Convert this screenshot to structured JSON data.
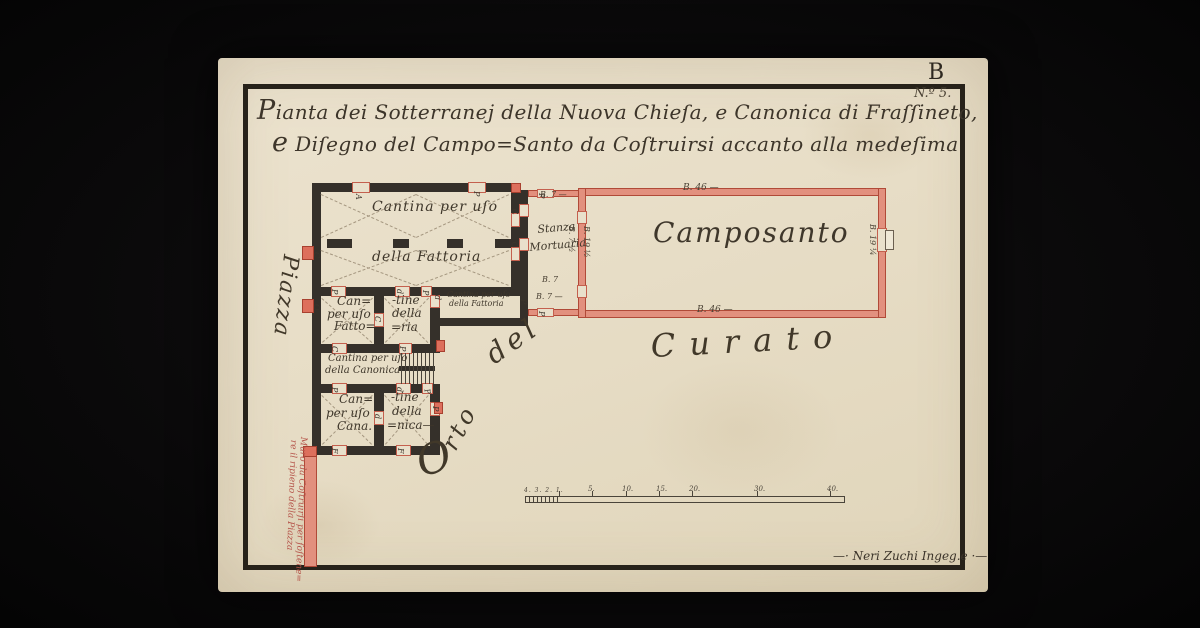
{
  "colors": {
    "paper": "#e8dfca",
    "ink": "#3d352a",
    "wall_dark": "#35302a",
    "wall_red_fill": "#e2907e",
    "wall_red_line": "#b04a38",
    "pier_red": "#dd6f5c",
    "note_red": "#b5544a"
  },
  "sheet": {
    "corner_letter": "B",
    "number": "N.º 5."
  },
  "title": {
    "line1": "Pianta dei Sotterranej della Nuova Chieſa, e Canonica di Fraſſineto,",
    "line2": "e Diſegno del Campo=Santo da Coſtruirsi accanto alla medeſima"
  },
  "plan": {
    "walls_dark": [
      {
        "x": 312,
        "y": 183,
        "w": 208,
        "h": 9
      },
      {
        "x": 312,
        "y": 183,
        "w": 9,
        "h": 272
      },
      {
        "x": 511,
        "y": 183,
        "w": 9,
        "h": 112
      },
      {
        "x": 312,
        "y": 287,
        "w": 216,
        "h": 9
      },
      {
        "x": 327,
        "y": 239,
        "w": 25,
        "h": 9
      },
      {
        "x": 393,
        "y": 239,
        "w": 16,
        "h": 9
      },
      {
        "x": 447,
        "y": 239,
        "w": 16,
        "h": 9
      },
      {
        "x": 495,
        "y": 239,
        "w": 16,
        "h": 9
      },
      {
        "x": 374,
        "y": 296,
        "w": 10,
        "h": 57
      },
      {
        "x": 430,
        "y": 296,
        "w": 10,
        "h": 57
      },
      {
        "x": 312,
        "y": 344,
        "w": 128,
        "h": 9
      },
      {
        "x": 374,
        "y": 393,
        "w": 10,
        "h": 62
      },
      {
        "x": 430,
        "y": 393,
        "w": 10,
        "h": 62
      },
      {
        "x": 312,
        "y": 384,
        "w": 128,
        "h": 9
      },
      {
        "x": 312,
        "y": 446,
        "w": 128,
        "h": 9
      },
      {
        "x": 440,
        "y": 318,
        "w": 80,
        "h": 8
      },
      {
        "x": 520,
        "y": 190,
        "w": 8,
        "h": 136
      },
      {
        "x": 399,
        "y": 366,
        "w": 36,
        "h": 5
      }
    ],
    "walls_red": [
      {
        "x": 528,
        "y": 190,
        "w": 52,
        "h": 7
      },
      {
        "x": 528,
        "y": 309,
        "w": 52,
        "h": 7
      },
      {
        "x": 578,
        "y": 188,
        "w": 308,
        "h": 8
      },
      {
        "x": 578,
        "y": 310,
        "w": 308,
        "h": 8
      },
      {
        "x": 578,
        "y": 188,
        "w": 8,
        "h": 130
      },
      {
        "x": 878,
        "y": 188,
        "w": 8,
        "h": 130
      },
      {
        "x": 304,
        "y": 455,
        "w": 13,
        "h": 112
      }
    ],
    "openings": [
      {
        "x": 352,
        "y": 182,
        "w": 18,
        "h": 11
      },
      {
        "x": 468,
        "y": 182,
        "w": 18,
        "h": 11
      },
      {
        "x": 511,
        "y": 213,
        "w": 9,
        "h": 14
      },
      {
        "x": 511,
        "y": 247,
        "w": 9,
        "h": 14
      },
      {
        "x": 331,
        "y": 286,
        "w": 15,
        "h": 11
      },
      {
        "x": 395,
        "y": 286,
        "w": 15,
        "h": 11
      },
      {
        "x": 421,
        "y": 286,
        "w": 11,
        "h": 11
      },
      {
        "x": 430,
        "y": 295,
        "w": 10,
        "h": 13
      },
      {
        "x": 332,
        "y": 343,
        "w": 15,
        "h": 11
      },
      {
        "x": 399,
        "y": 343,
        "w": 13,
        "h": 11
      },
      {
        "x": 332,
        "y": 383,
        "w": 15,
        "h": 11
      },
      {
        "x": 396,
        "y": 383,
        "w": 15,
        "h": 11
      },
      {
        "x": 422,
        "y": 383,
        "w": 11,
        "h": 11
      },
      {
        "x": 374,
        "y": 313,
        "w": 10,
        "h": 14
      },
      {
        "x": 374,
        "y": 411,
        "w": 10,
        "h": 14
      },
      {
        "x": 430,
        "y": 402,
        "w": 10,
        "h": 14
      },
      {
        "x": 332,
        "y": 445,
        "w": 15,
        "h": 11
      },
      {
        "x": 396,
        "y": 445,
        "w": 15,
        "h": 11
      },
      {
        "x": 537,
        "y": 189,
        "w": 17,
        "h": 9
      },
      {
        "x": 537,
        "y": 308,
        "w": 17,
        "h": 9
      },
      {
        "x": 519,
        "y": 204,
        "w": 10,
        "h": 13
      },
      {
        "x": 519,
        "y": 238,
        "w": 10,
        "h": 13
      },
      {
        "x": 577,
        "y": 211,
        "w": 10,
        "h": 13
      },
      {
        "x": 577,
        "y": 285,
        "w": 10,
        "h": 13
      },
      {
        "x": 877,
        "y": 228,
        "w": 10,
        "h": 24
      }
    ],
    "piers": [
      {
        "x": 302,
        "y": 246,
        "w": 12,
        "h": 14
      },
      {
        "x": 302,
        "y": 299,
        "w": 12,
        "h": 14
      },
      {
        "x": 511,
        "y": 183,
        "w": 10,
        "h": 10
      },
      {
        "x": 436,
        "y": 340,
        "w": 9,
        "h": 12
      },
      {
        "x": 434,
        "y": 402,
        "w": 9,
        "h": 12
      },
      {
        "x": 303,
        "y": 446,
        "w": 14,
        "h": 11
      }
    ],
    "dashes": [
      {
        "x": 321,
        "y": 194,
        "x2": 416,
        "y2": 237
      },
      {
        "x": 321,
        "y": 237,
        "x2": 416,
        "y2": 194
      },
      {
        "x": 416,
        "y": 194,
        "x2": 509,
        "y2": 237
      },
      {
        "x": 416,
        "y": 237,
        "x2": 509,
        "y2": 194
      },
      {
        "x": 321,
        "y": 250,
        "x2": 416,
        "y2": 285
      },
      {
        "x": 321,
        "y": 285,
        "x2": 416,
        "y2": 250
      },
      {
        "x": 416,
        "y": 250,
        "x2": 509,
        "y2": 285
      },
      {
        "x": 416,
        "y": 285,
        "x2": 509,
        "y2": 250
      },
      {
        "x": 322,
        "y": 298,
        "x2": 372,
        "y2": 342
      },
      {
        "x": 322,
        "y": 342,
        "x2": 372,
        "y2": 298
      },
      {
        "x": 385,
        "y": 298,
        "x2": 428,
        "y2": 342
      },
      {
        "x": 385,
        "y": 342,
        "x2": 428,
        "y2": 298
      },
      {
        "x": 322,
        "y": 395,
        "x2": 372,
        "y2": 444
      },
      {
        "x": 322,
        "y": 444,
        "x2": 372,
        "y2": 395
      },
      {
        "x": 385,
        "y": 395,
        "x2": 428,
        "y2": 444
      },
      {
        "x": 385,
        "y": 444,
        "x2": 428,
        "y2": 395
      }
    ],
    "stair_lines": [
      {
        "x": 401,
        "y": 353,
        "w": 1,
        "h": 31
      },
      {
        "x": 405,
        "y": 353,
        "w": 1,
        "h": 31
      },
      {
        "x": 409,
        "y": 353,
        "w": 1,
        "h": 31
      },
      {
        "x": 413,
        "y": 353,
        "w": 1,
        "h": 31
      },
      {
        "x": 417,
        "y": 353,
        "w": 1,
        "h": 31
      },
      {
        "x": 421,
        "y": 353,
        "w": 1,
        "h": 31
      },
      {
        "x": 425,
        "y": 353,
        "w": 1,
        "h": 31
      },
      {
        "x": 429,
        "y": 353,
        "w": 1,
        "h": 31
      },
      {
        "x": 433,
        "y": 353,
        "w": 1,
        "h": 31
      }
    ]
  },
  "labels": {
    "rooms": [
      {
        "t": "Cantina per uſo",
        "x": 372,
        "y": 200,
        "size": 14,
        "ls": 1
      },
      {
        "t": "della Fattoria",
        "x": 372,
        "y": 250,
        "size": 14,
        "ls": 1
      },
      {
        "t": "Stanza",
        "x": 537,
        "y": 224,
        "size": 11,
        "r": -5,
        "o": "0 0"
      },
      {
        "t": "Mortuaria",
        "x": 529,
        "y": 242,
        "size": 11,
        "r": -5,
        "o": "0 0"
      },
      {
        "t": "Camposanto",
        "x": 653,
        "y": 219,
        "size": 28,
        "ls": 2
      },
      {
        "t": "Can=",
        "x": 337,
        "y": 295,
        "size": 12
      },
      {
        "t": "per uſo",
        "x": 327,
        "y": 308,
        "size": 12
      },
      {
        "t": "Fatto=",
        "x": 334,
        "y": 320,
        "size": 12
      },
      {
        "t": "-tine",
        "x": 392,
        "y": 294,
        "size": 12
      },
      {
        "t": "della",
        "x": 392,
        "y": 307,
        "size": 12
      },
      {
        "t": "=ria",
        "x": 391,
        "y": 321,
        "size": 12
      },
      {
        "t": "Cantina per uſo",
        "x": 447,
        "y": 291,
        "size": 8
      },
      {
        "t": "della Fattoria",
        "x": 449,
        "y": 300,
        "size": 8
      },
      {
        "t": "Cantina per uſo",
        "x": 328,
        "y": 354,
        "size": 10
      },
      {
        "t": "della Canonica",
        "x": 325,
        "y": 366,
        "size": 10
      },
      {
        "t": "Can=",
        "x": 339,
        "y": 393,
        "size": 12
      },
      {
        "t": "per uſo",
        "x": 326,
        "y": 407,
        "size": 12
      },
      {
        "t": "Cana.",
        "x": 337,
        "y": 420,
        "size": 12
      },
      {
        "t": "-tine",
        "x": 391,
        "y": 391,
        "size": 12
      },
      {
        "t": "della",
        "x": 392,
        "y": 405,
        "size": 12
      },
      {
        "t": "=nica—",
        "x": 387,
        "y": 419,
        "size": 12
      }
    ],
    "areas": [
      {
        "t": "Piazza",
        "x": 301,
        "y": 256,
        "size": 22,
        "r": 97,
        "o": "0 0",
        "ls": 2
      },
      {
        "t": "O",
        "x": 411,
        "y": 444,
        "size": 42,
        "r": -18,
        "o": "0 0"
      },
      {
        "t": "rto",
        "x": 459,
        "y": 430,
        "size": 24,
        "r": -62,
        "o": "0 100%",
        "ls": 4
      },
      {
        "t": "del",
        "x": 481,
        "y": 346,
        "size": 28,
        "r": -35,
        "o": "0 0",
        "ls": 5
      },
      {
        "t": "Curato",
        "x": 650,
        "y": 330,
        "size": 32,
        "r": -3,
        "o": "0 0",
        "ls": 14
      }
    ],
    "letters": [
      {
        "t": "A",
        "x": 362,
        "y": 194,
        "r": 90,
        "o": "0 0"
      },
      {
        "t": "P",
        "x": 480,
        "y": 191,
        "r": 90,
        "o": "0 0"
      },
      {
        "t": "C",
        "x": 517,
        "y": 208,
        "r": 75,
        "o": "0 0"
      },
      {
        "t": "C",
        "x": 517,
        "y": 241,
        "r": 75,
        "o": "0 0"
      },
      {
        "t": "C",
        "x": 320,
        "y": 252,
        "r": 90,
        "o": "0 0"
      },
      {
        "t": "O",
        "x": 320,
        "y": 304,
        "r": 90,
        "o": "0 0"
      },
      {
        "t": "P",
        "x": 338,
        "y": 289,
        "r": 90,
        "o": "0 0"
      },
      {
        "t": "d",
        "x": 403,
        "y": 289,
        "r": 90,
        "o": "0 0"
      },
      {
        "t": "P",
        "x": 429,
        "y": 290,
        "r": 90,
        "o": "0 0"
      },
      {
        "t": "d",
        "x": 441,
        "y": 295,
        "r": 90,
        "o": "0 0"
      },
      {
        "t": "P",
        "x": 527,
        "y": 299,
        "r": 90,
        "o": "0 0"
      },
      {
        "t": "C",
        "x": 381,
        "y": 316,
        "r": 90,
        "o": "0 0"
      },
      {
        "t": "C",
        "x": 338,
        "y": 346,
        "r": 90,
        "o": "0 0"
      },
      {
        "t": "P",
        "x": 406,
        "y": 346,
        "r": 90,
        "o": "0 0"
      },
      {
        "t": "P",
        "x": 338,
        "y": 387,
        "r": 90,
        "o": "0 0"
      },
      {
        "t": "d",
        "x": 403,
        "y": 387,
        "r": 90,
        "o": "0 0"
      },
      {
        "t": "P",
        "x": 430,
        "y": 388,
        "r": 75,
        "o": "0 0"
      },
      {
        "t": "d",
        "x": 381,
        "y": 414,
        "r": 90,
        "o": "0 0"
      },
      {
        "t": "P",
        "x": 439,
        "y": 406,
        "r": 90,
        "o": "0 0"
      },
      {
        "t": "F",
        "x": 338,
        "y": 448,
        "r": 90,
        "o": "0 0"
      },
      {
        "t": "F",
        "x": 404,
        "y": 448,
        "r": 90,
        "o": "0 0"
      },
      {
        "t": "P",
        "x": 545,
        "y": 193,
        "r": 90,
        "o": "0 0"
      },
      {
        "t": "P",
        "x": 545,
        "y": 311,
        "r": 90,
        "o": "0 0"
      }
    ],
    "measurements": [
      {
        "t": "B. 46 —",
        "x": 683,
        "y": 184,
        "size": 9
      },
      {
        "t": "B. 46 —",
        "x": 697,
        "y": 306,
        "size": 9
      },
      {
        "t": "B. 19 ¼",
        "x": 876,
        "y": 224,
        "size": 8,
        "r": 90,
        "o": "0 0"
      },
      {
        "t": "B. 19 ½",
        "x": 590,
        "y": 226,
        "size": 8,
        "r": 90,
        "o": "0 0"
      },
      {
        "t": "B. 7 ½",
        "x": 575,
        "y": 226,
        "size": 8,
        "r": 90,
        "o": "0 0"
      },
      {
        "t": "B. 7 —",
        "x": 540,
        "y": 191,
        "size": 8
      },
      {
        "t": "B. 7",
        "x": 542,
        "y": 276,
        "size": 8
      },
      {
        "t": "B. 7 —",
        "x": 536,
        "y": 293,
        "size": 8
      }
    ]
  },
  "red_note": {
    "lines": [
      {
        "t": "Muro da Coſtruirſi per ſoſtene=",
        "x": 307,
        "y": 437,
        "size": 9,
        "r": 92,
        "o": "0 0",
        "c": "#b5544a"
      },
      {
        "t": "re il ripieno della Piazza",
        "x": 297,
        "y": 440,
        "size": 9,
        "r": 92,
        "o": "0 0",
        "c": "#b5544a"
      }
    ]
  },
  "scale_bar": {
    "micro_labels": "4. 3. 2. 1.",
    "ticks": [
      {
        "t": "5.",
        "x": 588,
        "y": 486
      },
      {
        "t": "10.",
        "x": 622,
        "y": 486
      },
      {
        "t": "15.",
        "x": 656,
        "y": 486
      },
      {
        "t": "20.",
        "x": 689,
        "y": 486
      },
      {
        "t": "30.",
        "x": 754,
        "y": 486
      },
      {
        "t": "40.",
        "x": 827,
        "y": 486
      }
    ],
    "tick_marks": [
      {
        "x": 559,
        "y": 491,
        "w": 1,
        "h": 5
      },
      {
        "x": 592,
        "y": 491,
        "w": 1,
        "h": 5
      },
      {
        "x": 626,
        "y": 491,
        "w": 1,
        "h": 5
      },
      {
        "x": 659,
        "y": 491,
        "w": 1,
        "h": 5
      },
      {
        "x": 692,
        "y": 491,
        "w": 1,
        "h": 5
      },
      {
        "x": 757,
        "y": 491,
        "w": 1,
        "h": 5
      },
      {
        "x": 830,
        "y": 491,
        "w": 1,
        "h": 5
      }
    ]
  },
  "signature": {
    "text": "—· Neri Zuchi Ingeg.e ·—"
  }
}
